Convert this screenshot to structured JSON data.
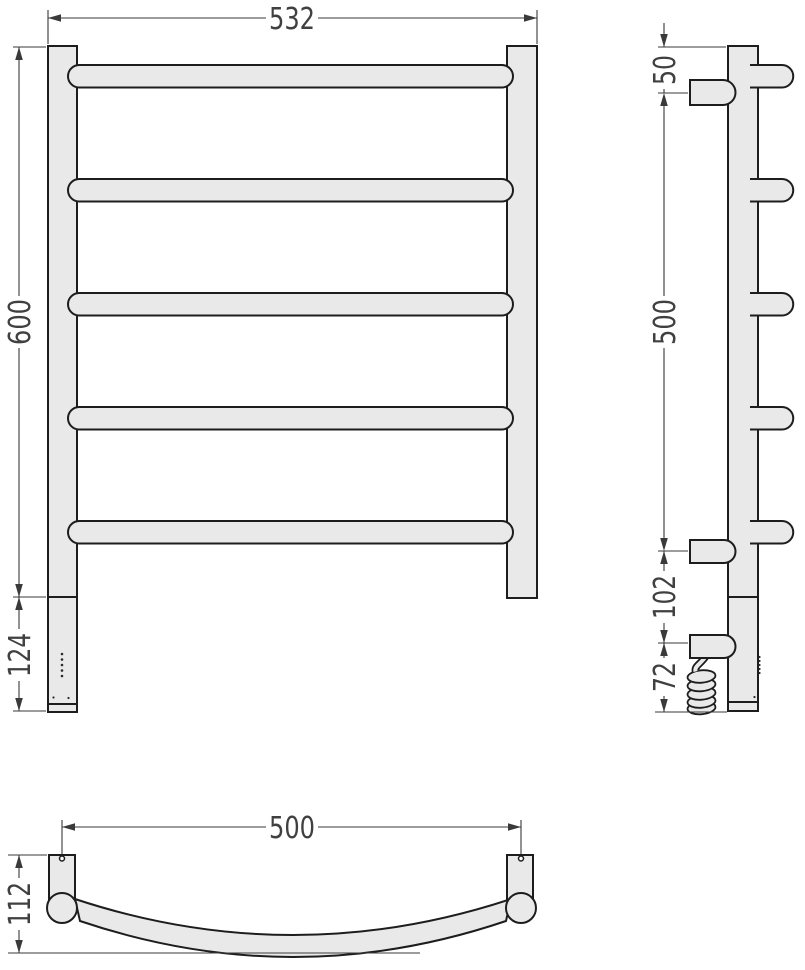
{
  "drawing": {
    "views": {
      "front": {
        "width": "532",
        "height": "600",
        "heater_section": "124"
      },
      "side": {
        "top_offset": "50",
        "bracket_span": "500",
        "bracket_to_cable": "102",
        "cable_drop": "72"
      },
      "top": {
        "mount_span": "500",
        "depth": "112"
      }
    }
  },
  "colors": {
    "background": "#ffffff",
    "part_fill": "#e9e9e9",
    "outline": "#1d1d1d",
    "dimension_line": "#3a3a3a",
    "dimension_text": "#404040"
  }
}
